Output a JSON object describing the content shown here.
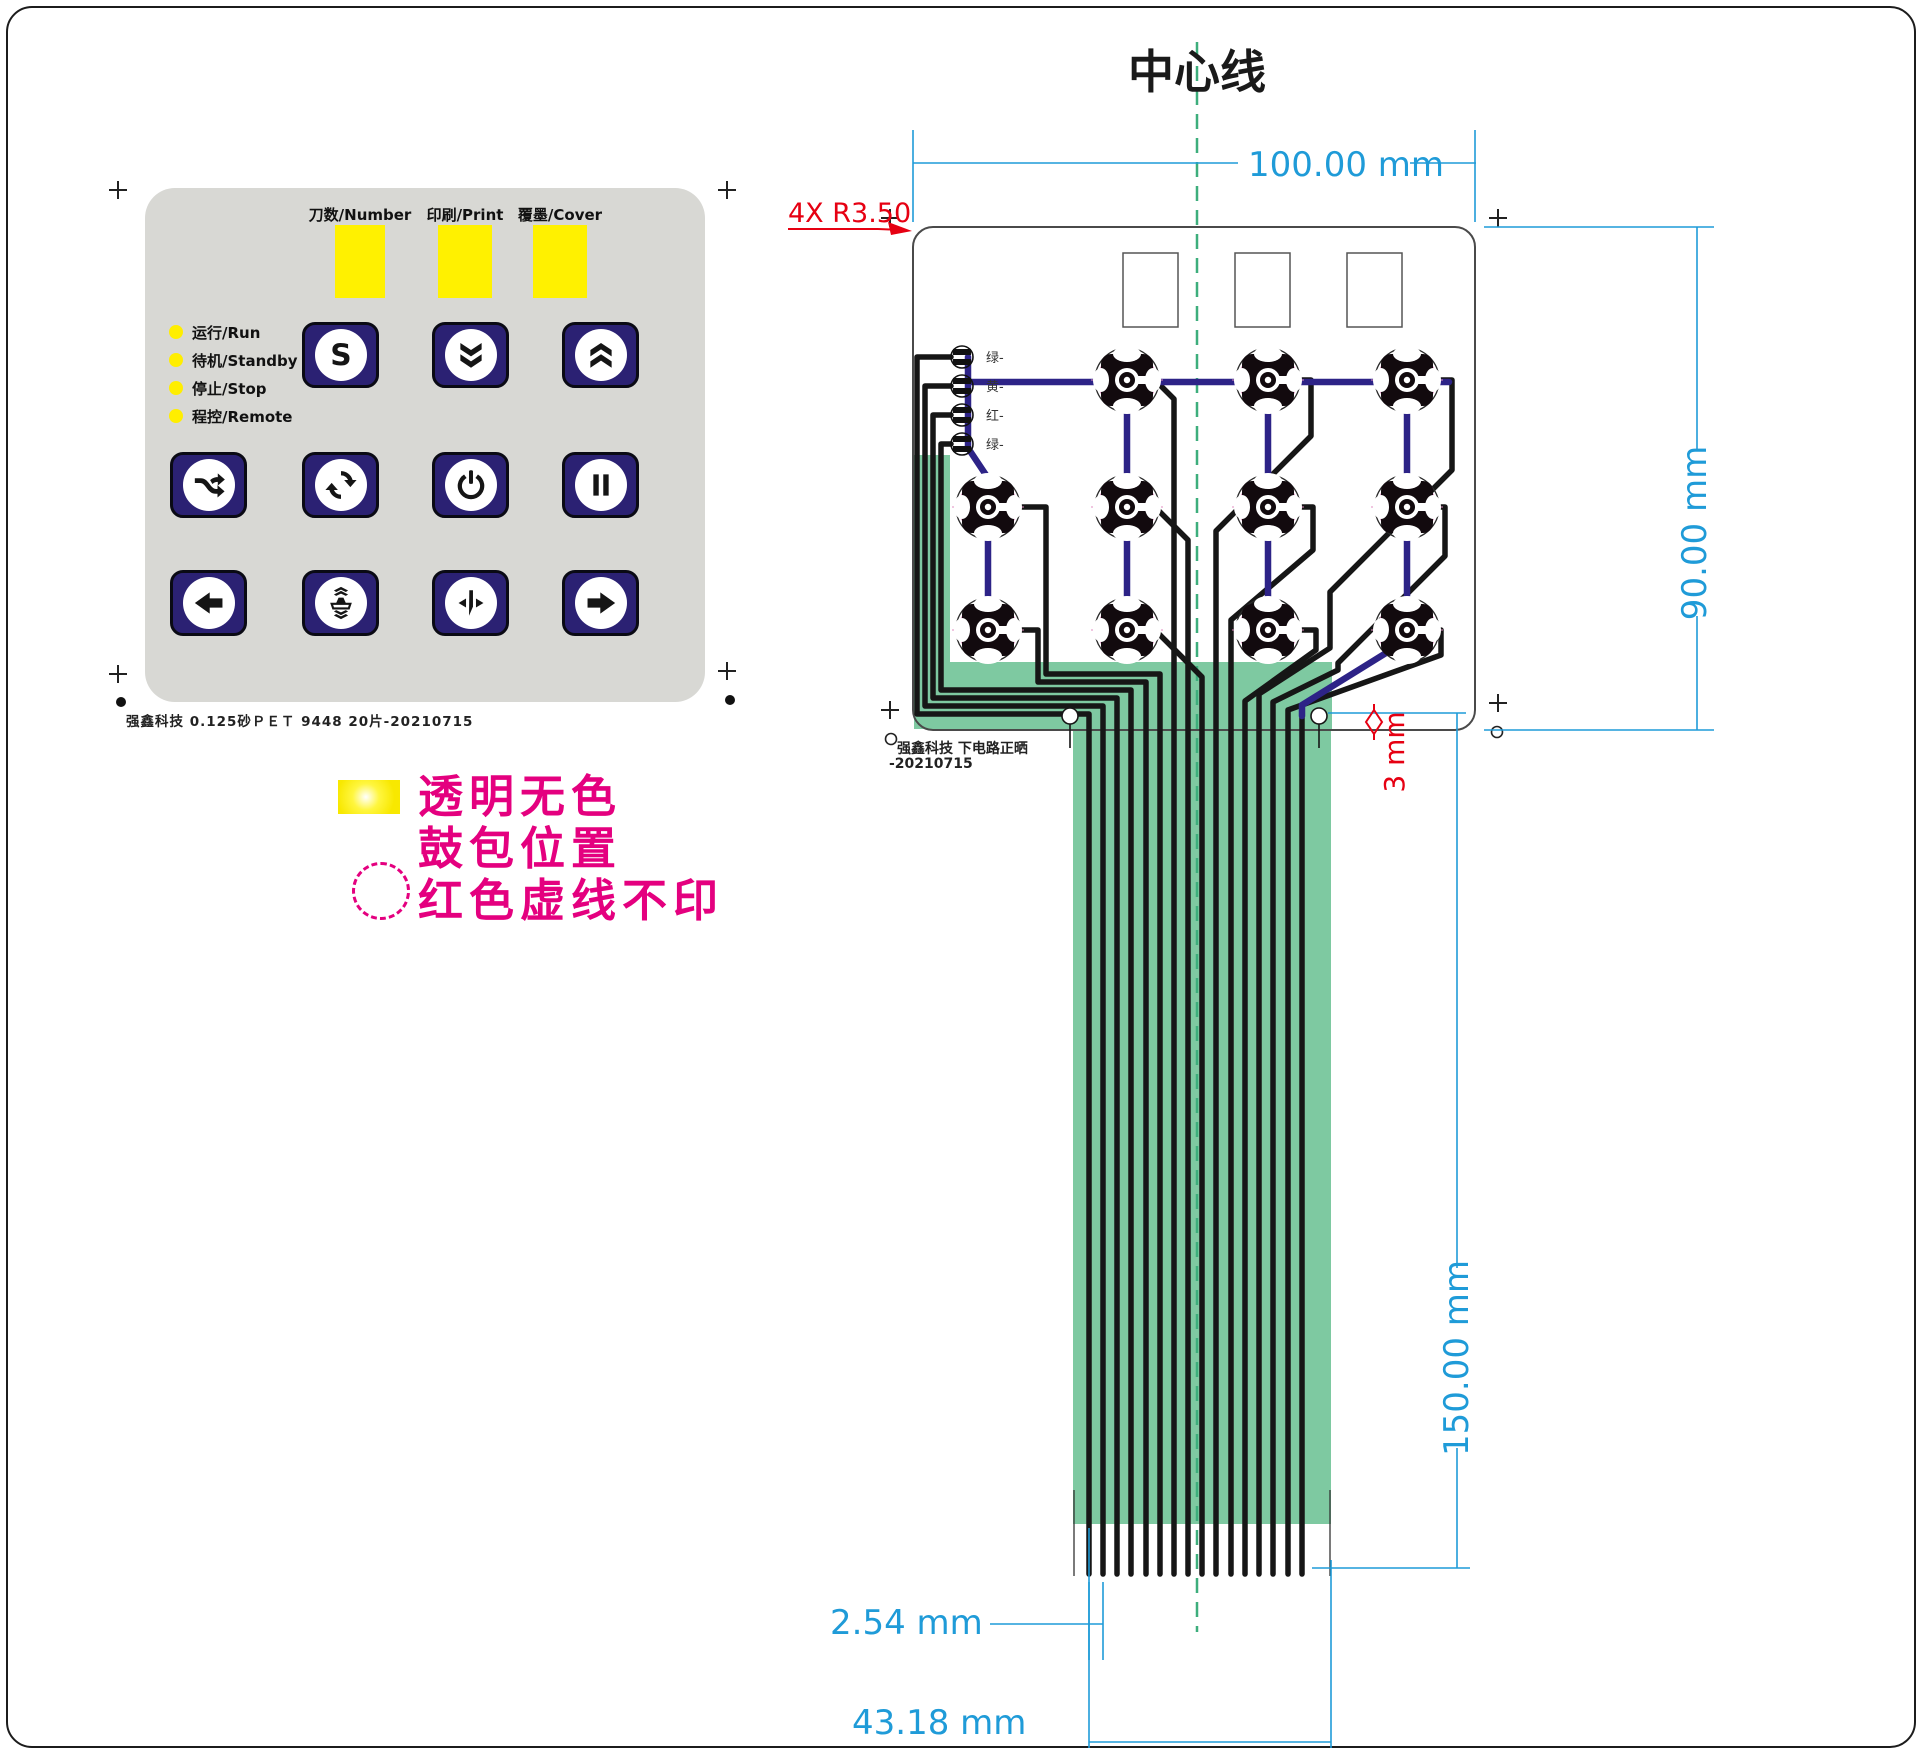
{
  "keypad": {
    "windows": [
      {
        "label": "刀数/Number"
      },
      {
        "label": "印刷/Print"
      },
      {
        "label": "覆墨/Cover"
      }
    ],
    "leds": [
      {
        "label": "运行/Run"
      },
      {
        "label": "待机/Standby"
      },
      {
        "label": "停止/Stop"
      },
      {
        "label": "程控/Remote"
      }
    ],
    "buttons": [
      {
        "icon": "s-glyph"
      },
      {
        "icon": "double-chevron-down"
      },
      {
        "icon": "double-chevron-up"
      },
      {
        "icon": "shuffle-arrows"
      },
      {
        "icon": "cycle-arrows"
      },
      {
        "icon": "power"
      },
      {
        "icon": "pause"
      },
      {
        "icon": "arrow-left"
      },
      {
        "icon": "press-plate"
      },
      {
        "icon": "cutter"
      },
      {
        "icon": "arrow-right"
      }
    ],
    "footer": "强鑫科技  0.125砂ＰＥＴ  9448  20片-20210715"
  },
  "legend": {
    "row1": "透明无色",
    "row2": "鼓包位置",
    "row3": "红色虚线不印"
  },
  "circuit": {
    "title": "中心线",
    "wire_labels": [
      "绿-",
      "黄-",
      "红-",
      "绿-"
    ],
    "note_company": "强鑫科技  下电路正晒",
    "note_date": "-20210715",
    "dim_width": "100.00 mm",
    "dim_height": "90.00 mm",
    "dim_tail": "150.00 mm",
    "dim_pitch": "2.54 mm",
    "dim_connector": "43.18 mm",
    "corner_note": "4X R3.50",
    "hole_note": "3 mm"
  },
  "colors": {
    "panel_gray": "#d8d8d4",
    "window_yellow": "#fff100",
    "button_navy": "#2b2173",
    "legend_magenta": "#e4007f",
    "dimension_cyan": "#1f9bd8",
    "annotation_red": "#e60012",
    "centerline_green": "#3dae7c",
    "tail_green": "#7ec9a1",
    "trace_blue": "#2d2387",
    "trace_black": "#161616"
  }
}
